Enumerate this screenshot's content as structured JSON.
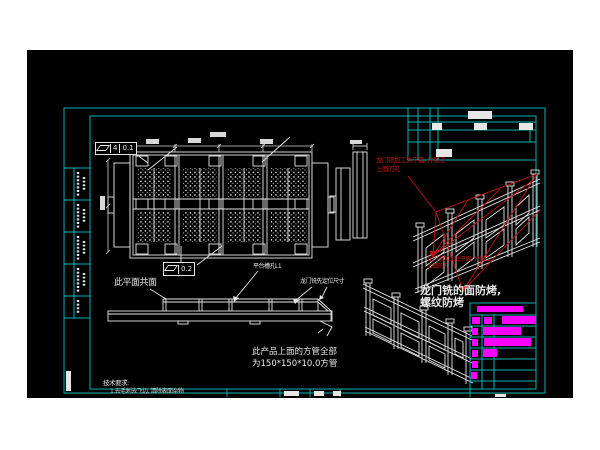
{
  "palette": {
    "page_background": "#ffffff",
    "canvas_background": "#000000",
    "frame_cyan": "#00b3b3",
    "line_white": "#e6e6e6",
    "annotation_red": "#c01414",
    "highlight_magenta": "#ff00ff"
  },
  "notes": {
    "coplanar": "此平面共面",
    "platform_slot": "平台槽孔L1",
    "gantry_locate": "龙门铣先定位尺寸",
    "red_note_top_line1": "龙门铣加工此平面, 并加工",
    "red_note_top_line2": "上面的孔",
    "red_note_bottom_line1": "龙门铣加工此平面, 并加工",
    "red_note_bottom_line2": "上面的孔",
    "milled_face_line1": "龙门铣的面防烤,",
    "milled_face_line2": "螺纹防烤",
    "square_tube_line1": "此产品上面的方管全部",
    "square_tube_line2": "为150*150*10.0方管",
    "tech_req_title": "技术要求:",
    "tech_req_item1": "1.去毛刺去飞边, 清除表面杂物"
  },
  "feature_controls": {
    "flatness_top_datum": "4",
    "flatness_top_value": "0.1",
    "flatness_mid_value": "0.2"
  }
}
